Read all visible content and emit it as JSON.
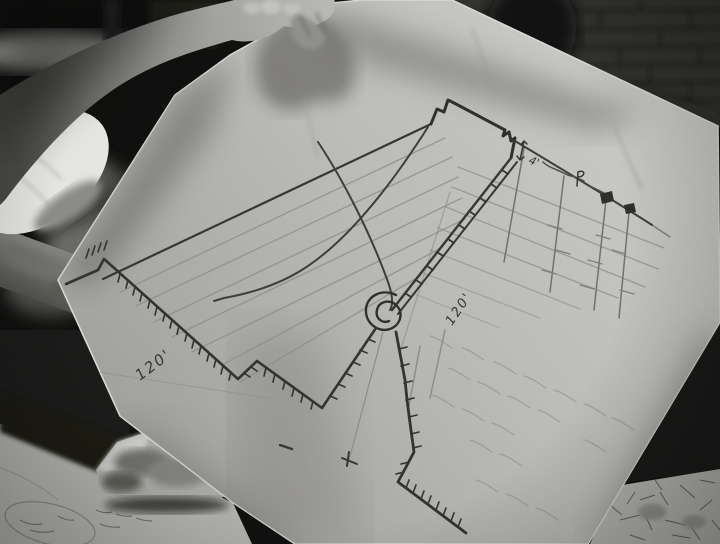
{
  "scene": {
    "medium": "black-and-white film still",
    "subject": "hand holding a hand-drawn wall-scaling sketch above a table of maps"
  },
  "sketch": {
    "labels": {
      "ground_distance": "120'",
      "height_distance": "120'",
      "parapet_height": "4'"
    },
    "features": [
      "crenellated wall top",
      "ladder against wall",
      "rope trajectory curves",
      "rope coil pulley",
      "hatched ground profile",
      "fence posts with flag markers",
      "dimension labels"
    ],
    "colors": {
      "paper": "#c3c3c0",
      "ink": "#32322f",
      "pencil": "#8a8a86",
      "background": "#0c0c0b"
    }
  }
}
